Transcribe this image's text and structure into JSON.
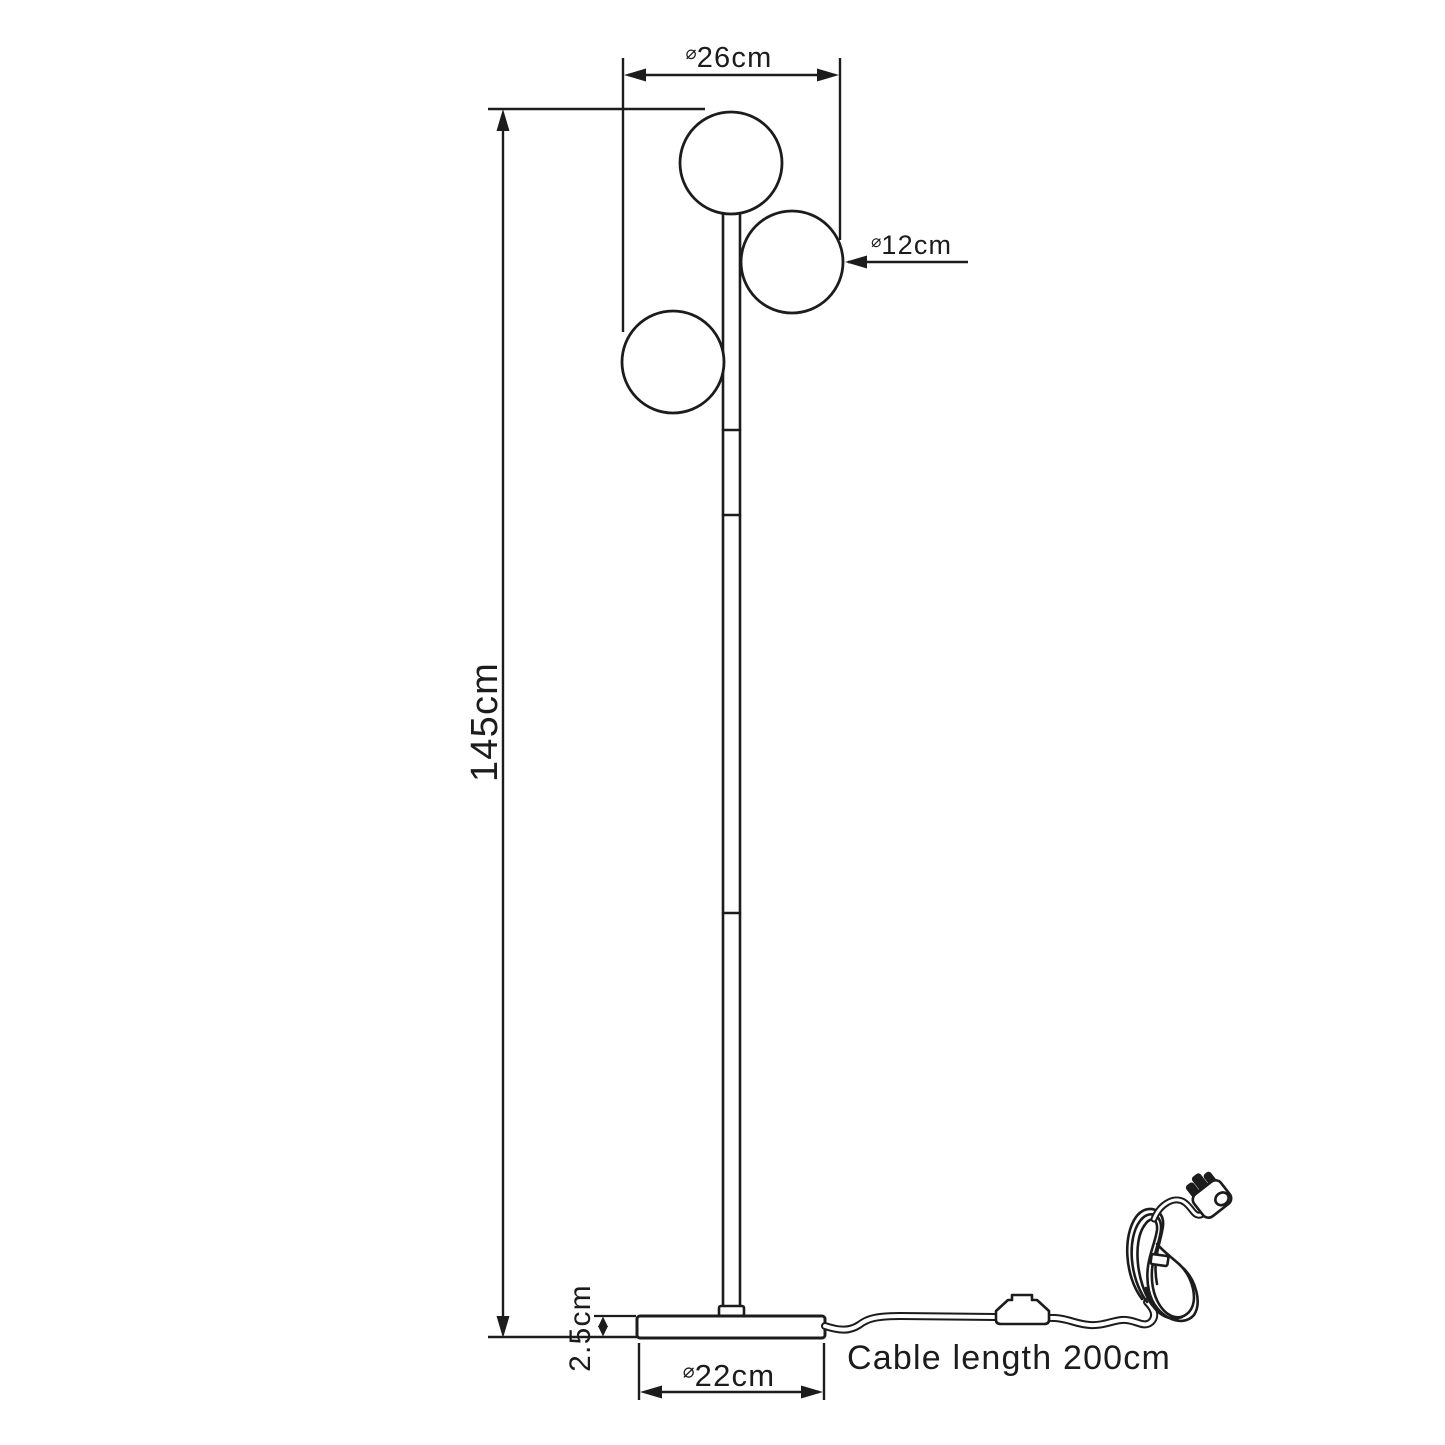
{
  "labels": {
    "overall_width": {
      "prefix": "⌀",
      "value": "26cm"
    },
    "globe_diameter": {
      "prefix": "⌀",
      "value": "12cm"
    },
    "lamp_height": "145cm",
    "base_height": "2.5cm",
    "base_diameter": {
      "prefix": "⌀",
      "value": "22cm"
    },
    "cable_length": "Cable length 200cm"
  },
  "colors": {
    "line": "#1c1c1c",
    "background": "#ffffff"
  }
}
